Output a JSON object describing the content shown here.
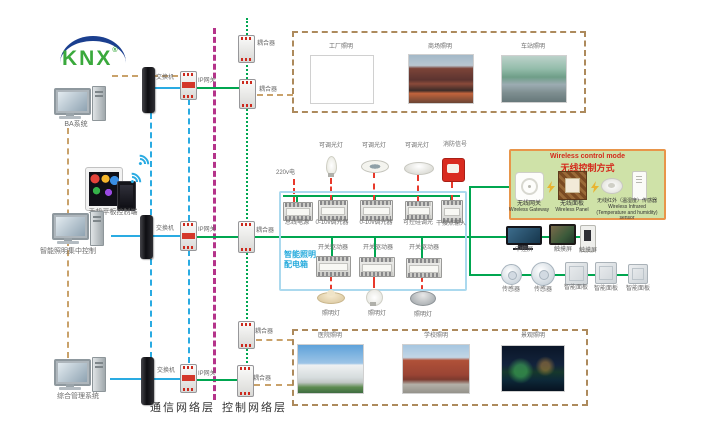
{
  "logo": {
    "text": "KNX",
    "registered": "®"
  },
  "computers": {
    "pc1": "BA系统",
    "mobile": "手机平板控制端",
    "pc2": "智能照明集中控制",
    "pc3": "综合管理系统"
  },
  "network": {
    "switch": "交换机",
    "ip_gateway": "IP网关",
    "coupler": "耦合器"
  },
  "layers": {
    "communication": "通信网络层",
    "control": "控制网络层"
  },
  "applications": {
    "top": [
      "工厂照明",
      "商场照明",
      "车站照明"
    ],
    "bottom": [
      "医院照明",
      "学校照明",
      "景观照明"
    ]
  },
  "distribution_box": {
    "name_line1": "智能照明",
    "name_line2": "配电箱",
    "power_input": "220v电",
    "top_devices": [
      "总线电源",
      "0-10v调光器",
      "0-10v调光器",
      "可控硅调光",
      "干接点输入"
    ],
    "top_loads": [
      "可调光灯",
      "可调光灯",
      "可调光灯",
      "消防信号"
    ],
    "bottom_devices": [
      "开关驱动器",
      "开关驱动器",
      "开关驱动器"
    ],
    "bottom_loads": [
      "照明灯",
      "照明灯",
      "照明灯"
    ]
  },
  "wireless": {
    "title_en": "Wireless control mode",
    "title_zh": "无线控制方式",
    "gateway_zh": "无线网关",
    "gateway_en": "Wireless Gateway",
    "panel_zh": "无线面板",
    "panel_en": "Wireless Panel",
    "sensor_zh": "无线红外（温湿度）传感器",
    "sensor_en": "Wireless Infrared (Temperature and humidity) sensor"
  },
  "right_devices": {
    "central_screen": "中控屏",
    "touch_screen_1": "触摸屏",
    "touch_screen_2": "触摸屏",
    "sensor_1": "传感器",
    "sensor_2": "传感器",
    "smart_panel_1": "智能面板",
    "smart_panel_2": "智能面板",
    "smart_panel_3": "智能面板"
  },
  "colors": {
    "bus_green": "#00a650",
    "link_blue": "#2aabe2",
    "divider_magenta": "#b5338a",
    "link_tan": "#c9a26b",
    "load_red": "#e8392b",
    "dist_box_border": "#abd9ee",
    "wireless_bg": "#cfe2a8",
    "wireless_border": "#e8954a",
    "knx_green": "#3aa93c",
    "knx_blue": "#1b3f8f"
  }
}
